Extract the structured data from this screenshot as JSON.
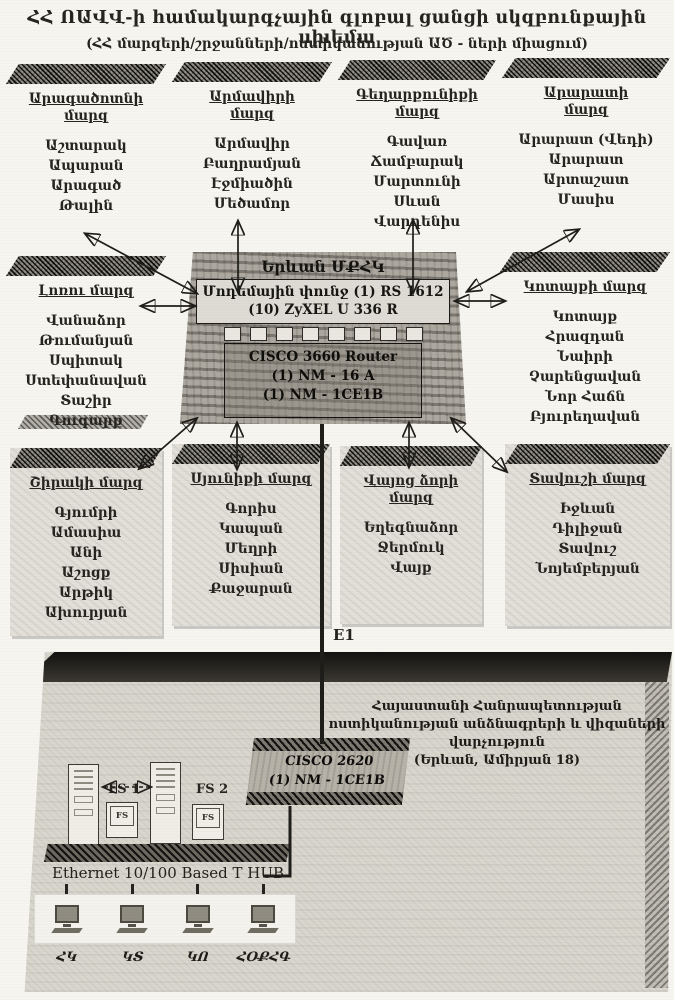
{
  "title": {
    "line1": "ՀՀ ՈԱՎՎ-ի համակարգչային գլոբալ ցանցի սկզբունքային սխեմա",
    "line2": "(ՀՀ մարզերի/շրջանների/ոստիկանության ԱԾ - ների միացում)"
  },
  "hub": {
    "name": "Երևան ՄՔՀԿ",
    "modem_line1": "Մոդեմային փունջ (1) RS 1612",
    "modem_line2": "(10) ZyXEL U 336 R",
    "router_line1": "CISCO 3660 Router",
    "router_line2": "(1) NM - 16 A",
    "router_line3": "(1) NM - 1CE1B"
  },
  "e1_label": "E1",
  "regions": [
    {
      "title_lines": [
        "Արագածոտնի",
        "մարզ"
      ],
      "cities": [
        "Աշտարակ",
        "Ապարան",
        "Արագած",
        "Թալին"
      ]
    },
    {
      "title_lines": [
        "Արմավիրի",
        "մարզ"
      ],
      "cities": [
        "Արմավիր",
        "Բաղրամյան",
        "Էջմիածին",
        "Մեծամոր"
      ]
    },
    {
      "title_lines": [
        "Գեղարքունիքի",
        "մարզ"
      ],
      "cities": [
        "Գավառ",
        "Ճամբարակ",
        "Մարտունի",
        "Սևան",
        "Վարդենիս"
      ]
    },
    {
      "title_lines": [
        "Արարատի",
        "մարզ"
      ],
      "cities": [
        "Արարատ (Վեդի)",
        "Արարատ",
        "Արտաշատ",
        "Մասիս"
      ]
    },
    {
      "title_lines": [
        "Լոռու մարզ"
      ],
      "cities": [
        "Վանաձոր",
        "Թումանյան",
        "Սպիտակ",
        "Ստեփանավան",
        "Տաշիր",
        "Գուգարք"
      ]
    },
    {
      "title_lines": [
        "Կոտայքի մարզ"
      ],
      "cities": [
        "Կոտայք",
        "Հրազդան",
        "Նաիրի",
        "Չարենցավան",
        "Նոր Հաճն",
        "Բյուրեղավան"
      ]
    },
    {
      "title_lines": [
        "Շիրակի մարզ"
      ],
      "cities": [
        "Գյումրի",
        "Ամասիա",
        "Անի",
        "Աշոցք",
        "Արթիկ",
        "Ախուրյան"
      ]
    },
    {
      "title_lines": [
        "Սյունիքի մարզ"
      ],
      "cities": [
        "Գորիս",
        "Կապան",
        "Մեղրի",
        "Սիսիան",
        "Քաջարան"
      ]
    },
    {
      "title_lines": [
        "Վայոց ձորի",
        "մարզ"
      ],
      "cities": [
        "Եղեգնաձոր",
        "Ջերմուկ",
        "Վայք"
      ]
    },
    {
      "title_lines": [
        "Տավուշի մարզ"
      ],
      "cities": [
        "Իջևան",
        "Դիլիջան",
        "Տավուշ",
        "Նոյեմբերյան"
      ]
    }
  ],
  "building": {
    "dept_line1": "Հայաստանի Հանրապետության",
    "dept_line2": "ոստիկանության անձնագրերի և վիզաների",
    "dept_line3": "վարչություն",
    "dept_line4": "(Երևան, Ամիրյան 18)",
    "router_line1": "CISCO 2620",
    "router_line2": "(1) NM - 1CE1B",
    "fs1_label": "FS 1",
    "fs2_label": "FS 2",
    "fs_screen_label": "FS",
    "ethernet_hub_label": "Ethernet 10/100 Based T HUB",
    "workstations": [
      "ՀԿ",
      "ԿՏ",
      "ԿՈ",
      "ՀՕՔՀԳ"
    ]
  }
}
